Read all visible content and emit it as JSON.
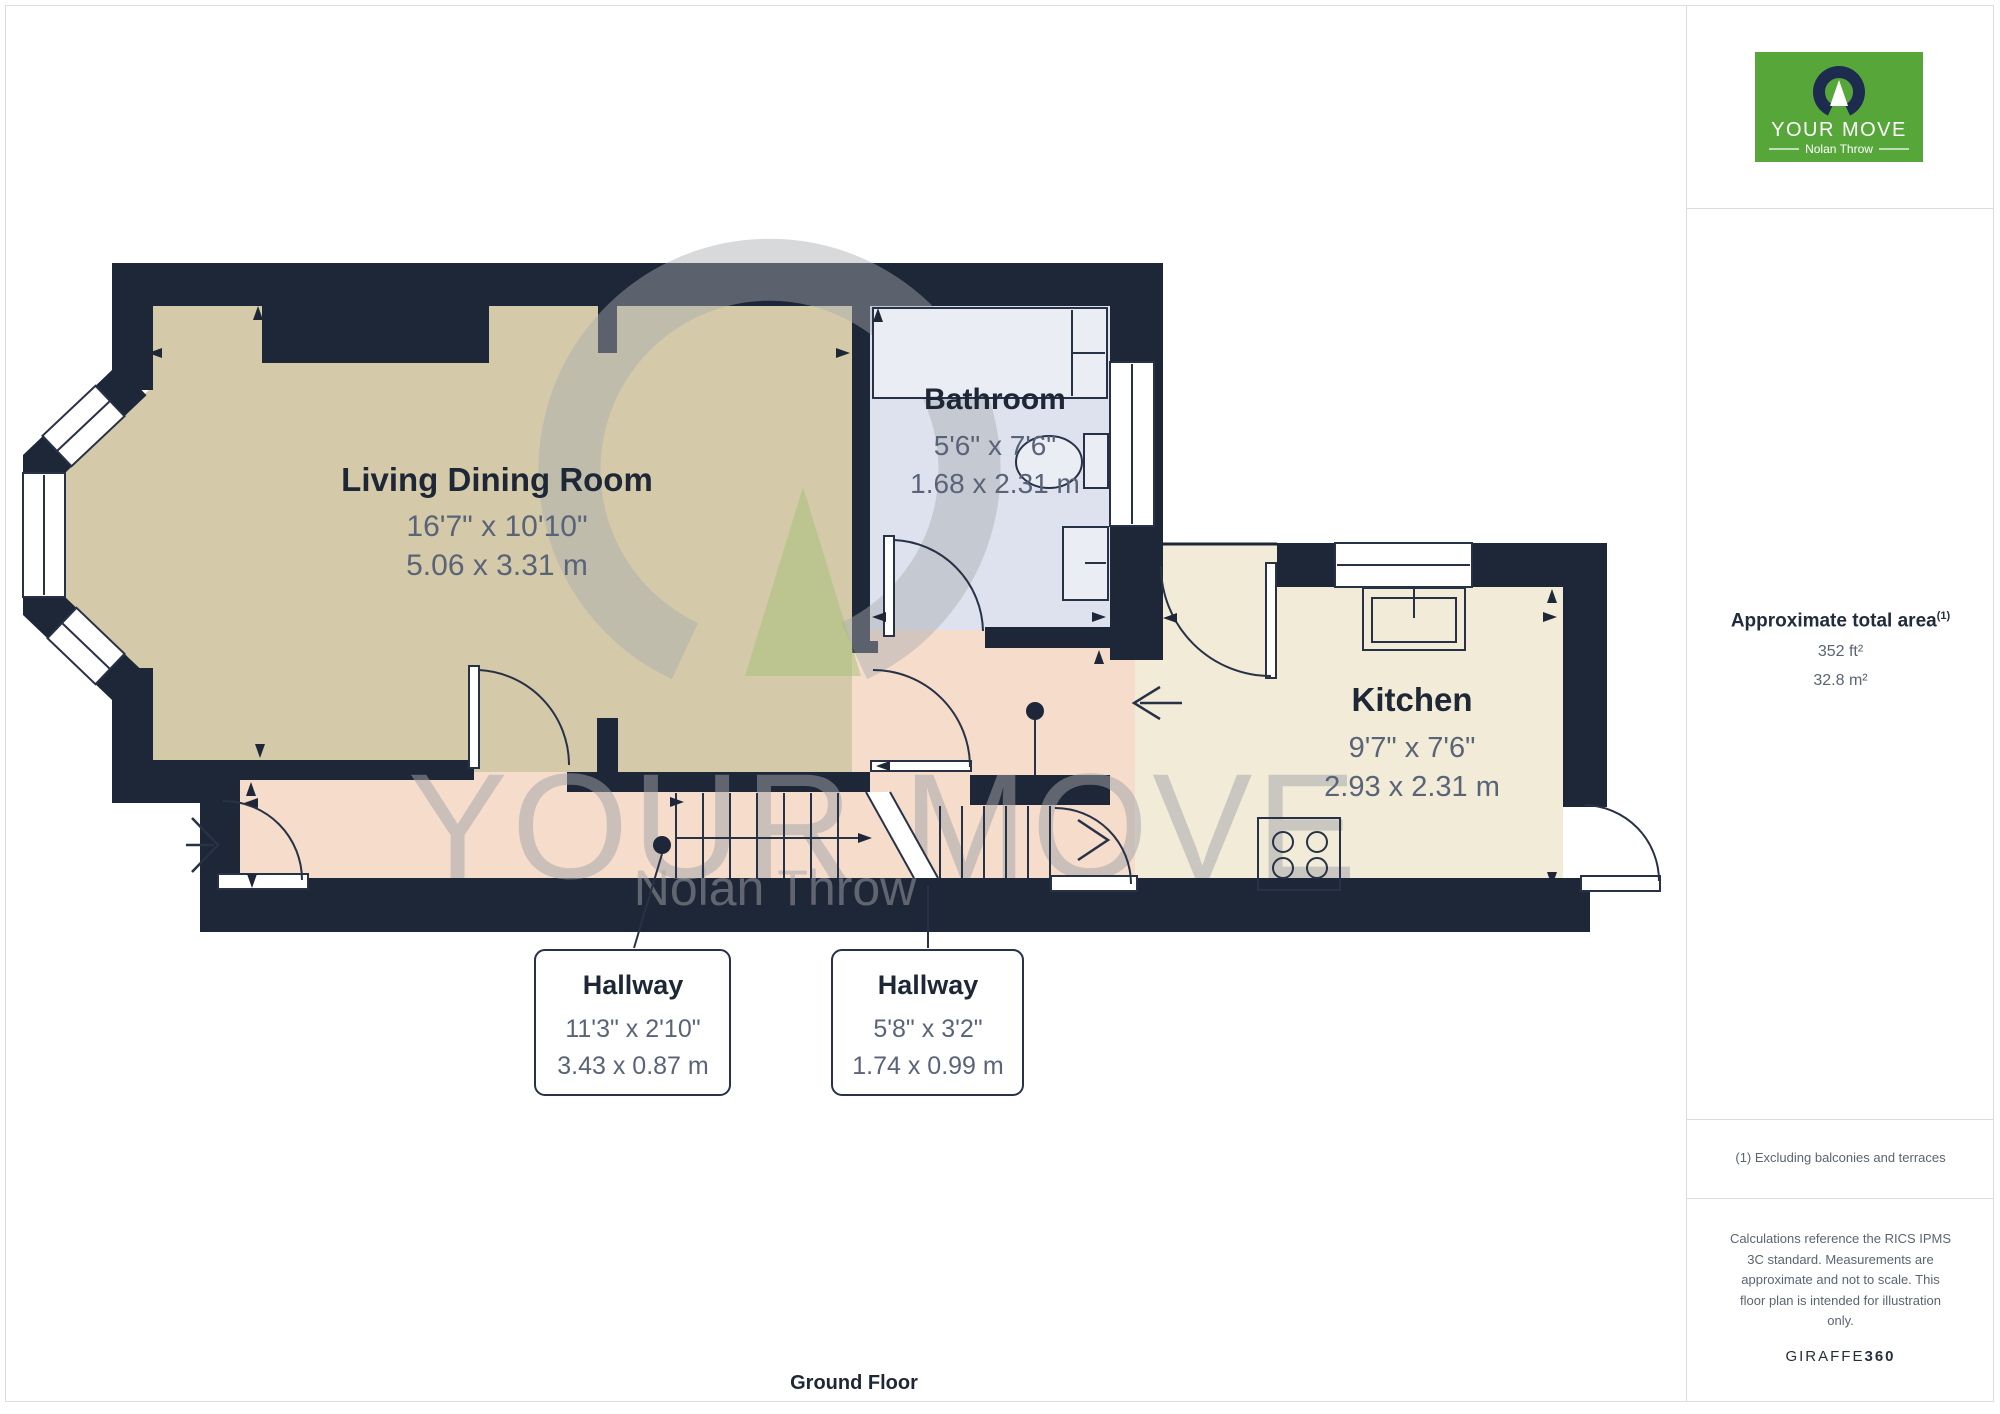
{
  "page": {
    "floor_label": "Ground Floor"
  },
  "logo": {
    "brand": "YOUR MOVE",
    "subtitle": "Nolan Throw"
  },
  "watermark": {
    "line1": "YOUR MOVE",
    "line2": "Nolan Throw"
  },
  "rooms": {
    "living": {
      "name": "Living Dining Room",
      "imperial": "16'7\" x 10'10\"",
      "metric": "5.06 x 3.31 m"
    },
    "bathroom": {
      "name": "Bathroom",
      "imperial": "5'6\" x 7'6\"",
      "metric": "1.68 x 2.31 m"
    },
    "kitchen": {
      "name": "Kitchen",
      "imperial": "9'7\" x 7'6\"",
      "metric": "2.93 x 2.31 m"
    },
    "hallway1": {
      "name": "Hallway",
      "imperial": "11'3\" x 2'10\"",
      "metric": "3.43 x 0.87 m"
    },
    "hallway2": {
      "name": "Hallway",
      "imperial": "5'8\" x 3'2\"",
      "metric": "1.74 x 0.99 m"
    }
  },
  "sidebar": {
    "area_title": "Approximate total area",
    "area_footnote_marker": "(1)",
    "area_ft": "352 ft²",
    "area_m": "32.8 m²",
    "footnote": "(1) Excluding balconies and terraces",
    "calc_lines": [
      "Calculations reference the RICS IPMS",
      "3C standard. Measurements are",
      "approximate and not to scale. This",
      "floor plan is intended for illustration",
      "only."
    ],
    "brand_giraffe": "GIRAFFE",
    "brand_360": "360"
  },
  "colors": {
    "wall": "#1e2737",
    "living_fill": "#d4caa9",
    "kitchen_fill": "#f1ebd8",
    "hallway_fill": "#f5dccb",
    "bathroom_fill": "#dde2ee",
    "fixture_fill": "#eaedf4",
    "logo_green": "#57a639",
    "logo_navy": "#1d2b4f",
    "text_dark": "#1e2736",
    "text_gray": "#5a6478",
    "border": "#dcdcdc",
    "watermark_gray": "#a9abb0",
    "watermark_green": "#a3bf77"
  },
  "icons": {
    "logo_mark": "horseshoe-arrow-icon",
    "stair_direction": "stair-direction-arrow-icon",
    "entry_arrows": "open-chevron-arrow-icon"
  }
}
